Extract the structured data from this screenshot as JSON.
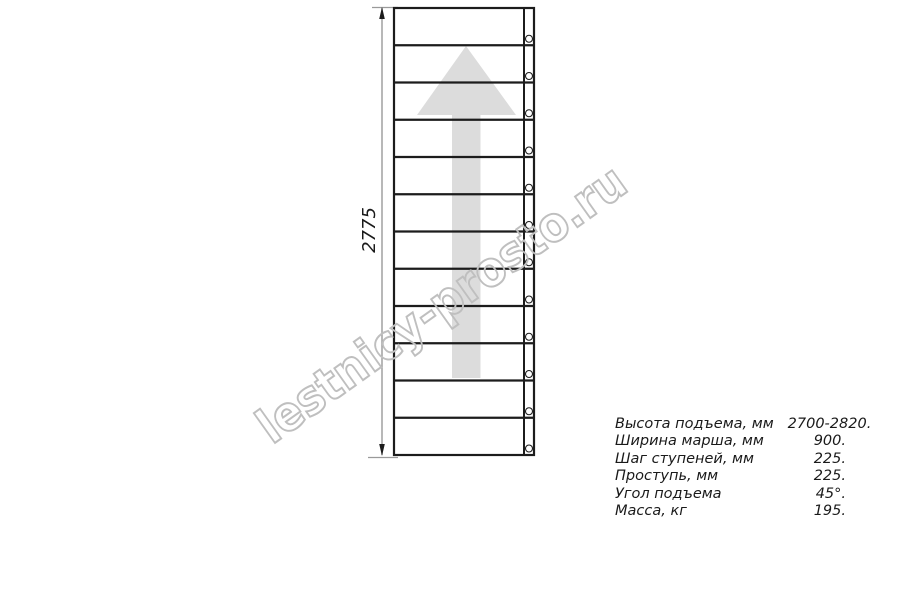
{
  "colors": {
    "line": "#1c1c1c",
    "dimension": "#9a9a9a",
    "arrow_fill": "#dcdcdc",
    "watermark": "#bfbfbf",
    "text": "#1a1a1a"
  },
  "watermark": {
    "text": "lestnicy-prosto.ru"
  },
  "drawing": {
    "dimension_label": "2775",
    "treads": 12,
    "geometry": {
      "left": 394,
      "right": 534,
      "top": 8,
      "bottom": 455,
      "stringer_x": 524,
      "bolt_cx": 529,
      "bolt_r": 3.5,
      "bolt_offset": 6.5
    }
  },
  "specs": {
    "rows": [
      {
        "label": "Высота подъема, мм",
        "value": "2700-2820."
      },
      {
        "label": "Ширина марша, мм",
        "value": "900."
      },
      {
        "label": "Шаг ступеней, мм",
        "value": "225."
      },
      {
        "label": "Проступь, мм",
        "value": "225."
      },
      {
        "label": "Угол подъема",
        "value": "45°."
      },
      {
        "label": "Масса, кг",
        "value": "195."
      }
    ]
  }
}
